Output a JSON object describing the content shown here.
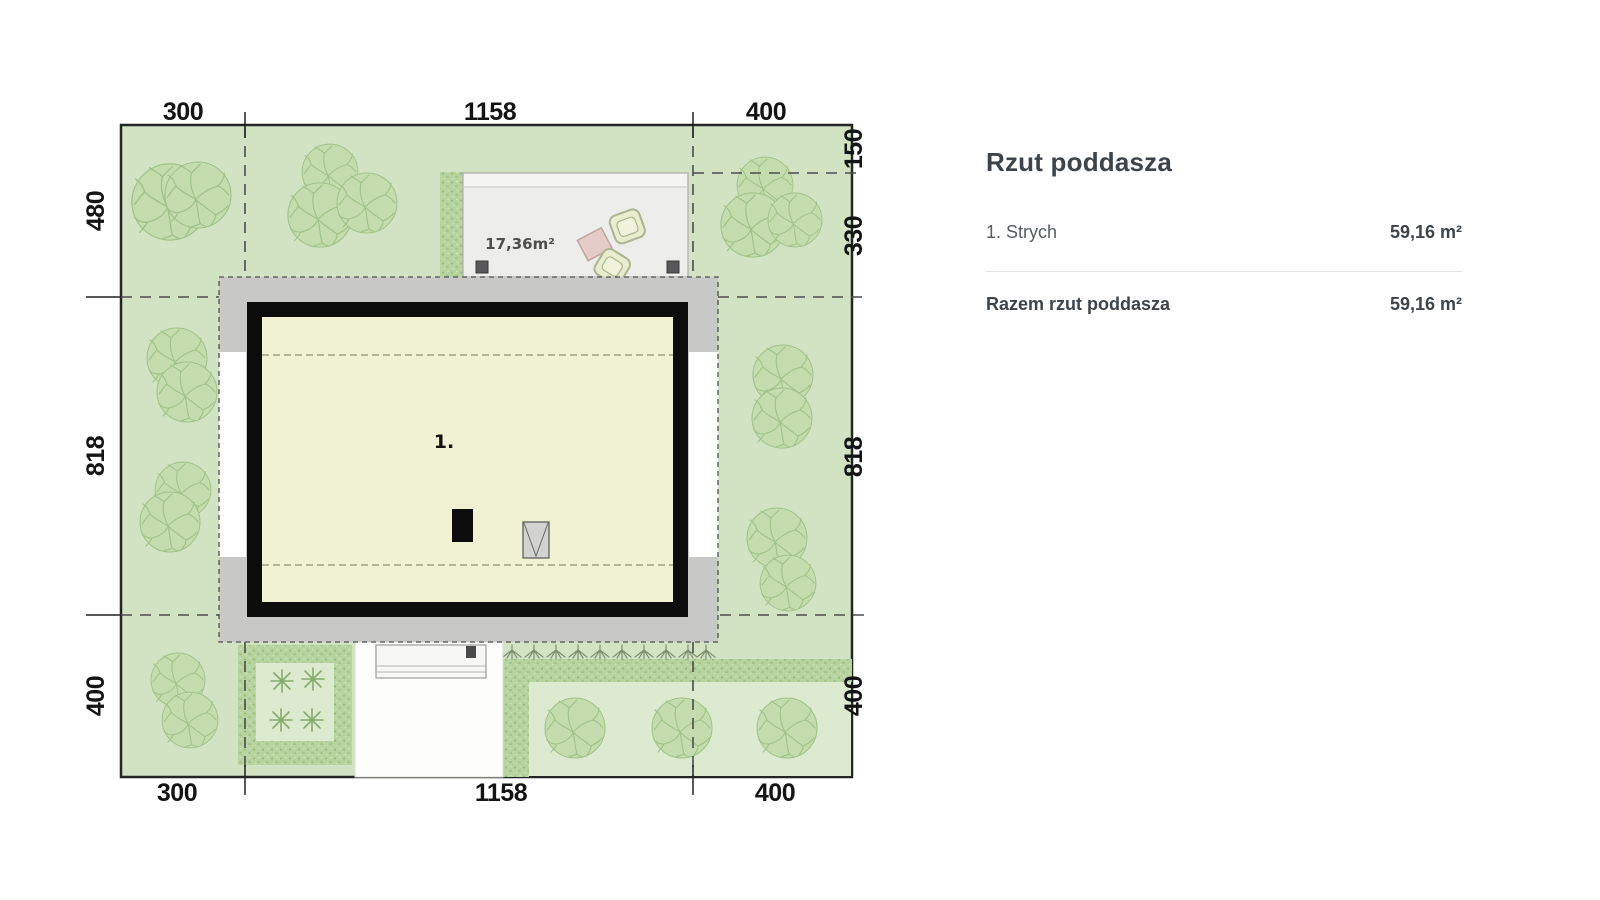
{
  "panel": {
    "title": "Rzut poddasza",
    "rows": [
      {
        "label": "1. Strych",
        "value": "59,16 m²"
      }
    ],
    "total": {
      "label": "Razem rzut poddasza",
      "value": "59,16 m²"
    }
  },
  "plan": {
    "room_label": "1.",
    "terrace_area_label": "17,36m²",
    "dims": {
      "top": [
        "300",
        "1158",
        "400"
      ],
      "bottom": [
        "300",
        "1158",
        "400"
      ],
      "left": [
        "480",
        "818",
        "400"
      ],
      "right": [
        "150",
        "330",
        "818",
        "400"
      ]
    },
    "colors": {
      "grass": "#d2e3c3",
      "grass_light": "#dcead0",
      "tree_fill": "#c5ddae",
      "tree_line": "#9fc288",
      "hedge": "#b7d39f",
      "eaves": "#c8c8c6",
      "wall": "#0c0c0c",
      "interior": "#f0f2d3",
      "terrace": "#ededeb",
      "terrace_step": "#f4f4f2",
      "white_area": "#fdfdfc",
      "dash_line": "#4c4c4c",
      "dim_text": "#141414",
      "knee_line": "#8e8e7c",
      "table_pink": "#e4cdc8",
      "table_pink_line": "#c2a39e",
      "chair_fill": "#e9ecce",
      "chair_line": "#aab690",
      "post": "#58585a",
      "panel_title": "#3e444b",
      "panel_text": "#565c63",
      "divider": "#e4e4e4"
    }
  }
}
